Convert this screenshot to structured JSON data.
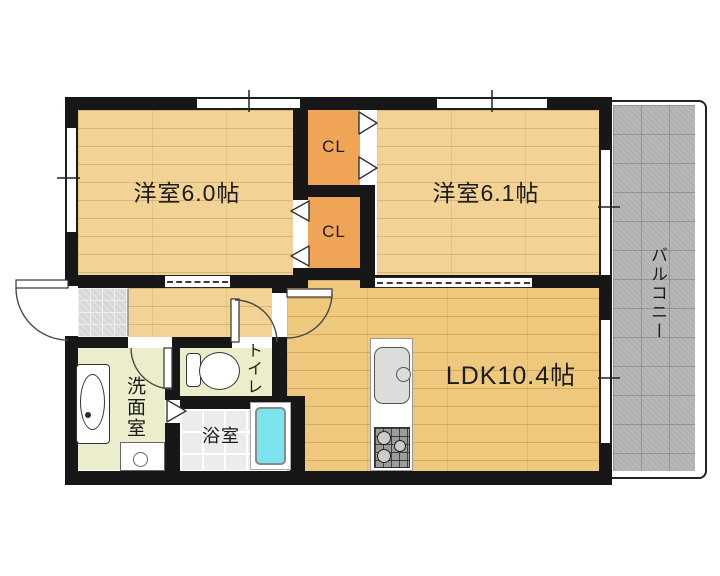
{
  "floor_plan": {
    "rooms": {
      "bedroom1": {
        "label": "洋室6.0帖"
      },
      "bedroom2": {
        "label": "洋室6.1帖"
      },
      "ldk": {
        "label": "LDK10.4帖"
      },
      "closet_upper": {
        "label": "CL"
      },
      "closet_lower": {
        "label": "CL"
      },
      "washroom": {
        "label": "洗面室"
      },
      "toilet": {
        "label": "トイレ"
      },
      "bathroom": {
        "label": "浴室"
      },
      "balcony": {
        "label": "バルコニー"
      }
    },
    "colors": {
      "wall": "#171717",
      "wood_floor": "#f2d395",
      "ldk_floor": "#eec97d",
      "closet": "#f0a455",
      "wet_room_floor": "#ecedcb",
      "bath_tile": "#ececec",
      "genkan_tile": "#d7d7d7",
      "balcony": "#b1b1b1",
      "bathtub": "#7be3ee",
      "background": "#ffffff"
    }
  }
}
